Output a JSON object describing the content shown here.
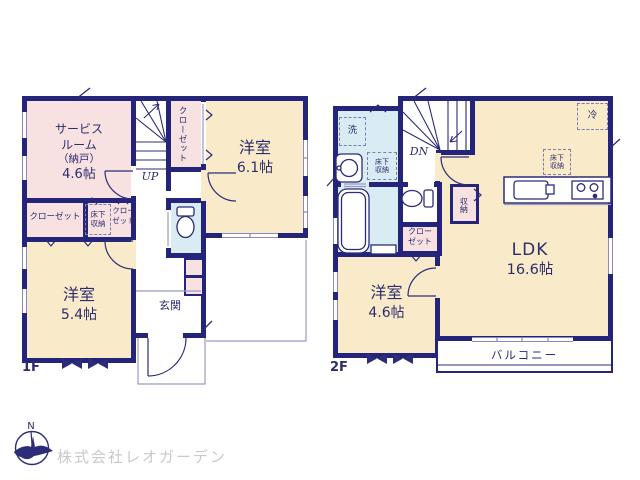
{
  "floor1": {
    "label": "1F",
    "service_room": {
      "l1": "サービス",
      "l2": "ルーム",
      "l3": "（納戸）",
      "l4": "4.6帖"
    },
    "closet_top": "クローゼット",
    "western_6_1": {
      "name": "洋室",
      "size": "6.1帖"
    },
    "closet_left": "クローゼット",
    "underfloor_storage": {
      "l1": "床下",
      "l2": "収納"
    },
    "closet_mid": {
      "l1": "クロー",
      "l2": "ゼット"
    },
    "western_5_4": {
      "name": "洋室",
      "size": "5.4帖"
    },
    "entrance": "玄関",
    "stairs_up": "UP"
  },
  "floor2": {
    "label": "2F",
    "laundry": "洗",
    "underfloor_storage_wash": {
      "l1": "床下",
      "l2": "収納"
    },
    "stairs_down": "DN",
    "storage": "収納",
    "closet": {
      "l1": "クロー",
      "l2": "ゼット"
    },
    "western_4_6": {
      "name": "洋室",
      "size": "4.6帖"
    },
    "ldk": {
      "name": "LDK",
      "size": "16.6帖"
    },
    "underfloor_storage_kitchen": {
      "l1": "床下",
      "l2": "収納"
    },
    "refrigerator": "冷",
    "balcony": "バルコニー"
  },
  "footer": {
    "company": "株式会社レオガーデン",
    "compass_north": "N"
  },
  "colors": {
    "wall": "#24247b",
    "room_pink": "#f8e2e1",
    "room_cream": "#f9ebca",
    "room_blue": "#d9ecf4",
    "text_navy": "#2c2c6e",
    "company_gray": "#c9c9c9"
  }
}
